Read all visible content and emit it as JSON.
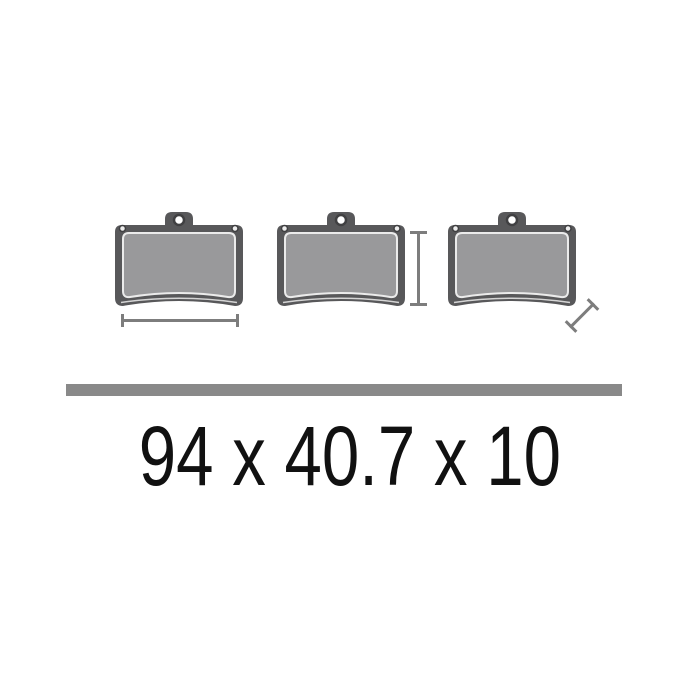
{
  "product": {
    "dimensions_text": "94 x 40.7 x 10",
    "dimensions": {
      "width_mm": 94,
      "height_mm": 40.7,
      "thickness_mm": 10
    },
    "pads": [
      {
        "id": "brake-pad-1",
        "dimension_marker": "width"
      },
      {
        "id": "brake-pad-2",
        "dimension_marker": "height"
      },
      {
        "id": "brake-pad-3",
        "dimension_marker": "thickness"
      }
    ]
  },
  "icons": {
    "pad": "brake-pad-icon",
    "width_marker": "horizontal-dimension-marker-icon",
    "height_marker": "vertical-dimension-marker-icon",
    "thickness_marker": "diagonal-dimension-marker-icon"
  },
  "colors": {
    "background": "#ffffff",
    "backing_plate": "#58585a",
    "friction_material": "#99999b",
    "pad_outline": "#ebebeb",
    "hole_ring": "#404042",
    "dimension_marker": "#7d7d7d",
    "divider_bar": "#898989",
    "text": "#111111"
  }
}
